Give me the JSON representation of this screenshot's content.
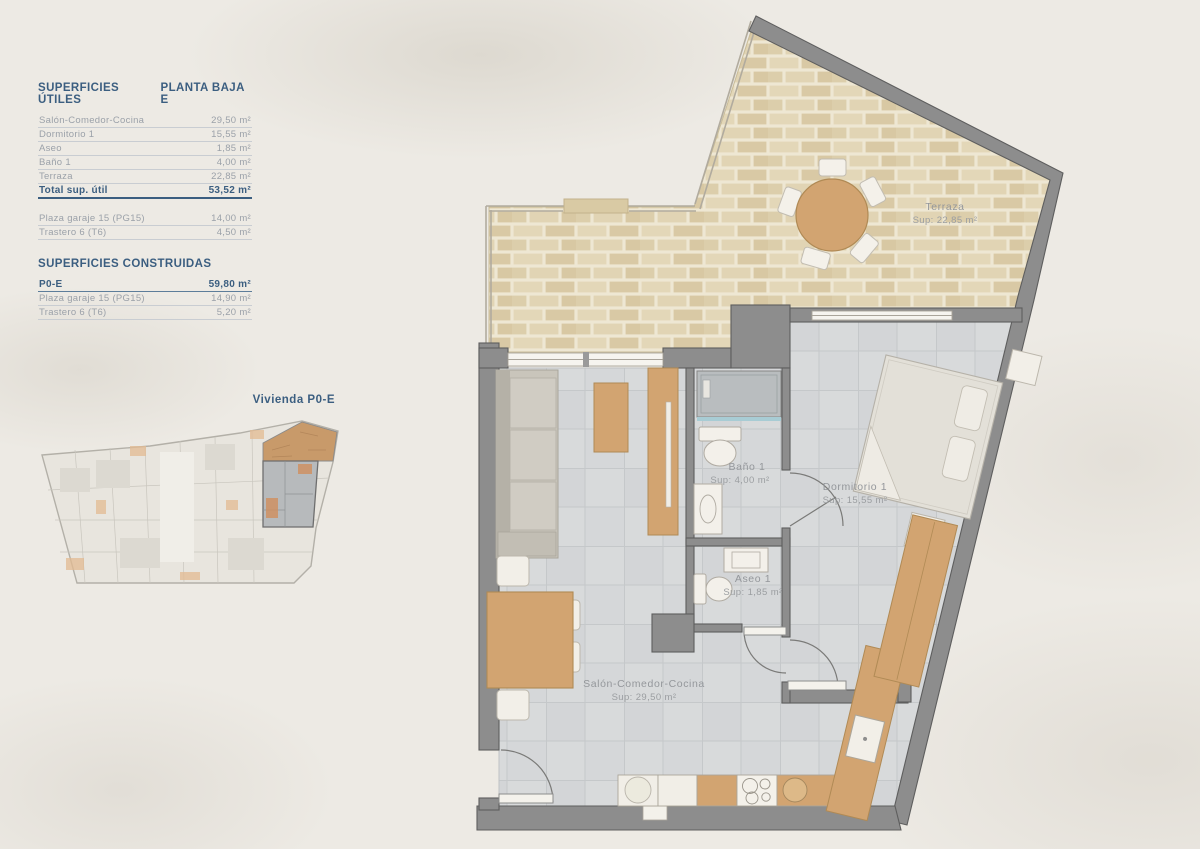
{
  "panel": {
    "title": "SUPERFICIES ÚTILES",
    "plan_name": "PLANTA BAJA E",
    "rows": [
      {
        "label": "Salón-Comedor-Cocina",
        "value": "29,50 m²"
      },
      {
        "label": "Dormitorio 1",
        "value": "15,55 m²"
      },
      {
        "label": "Aseo",
        "value": "1,85 m²"
      },
      {
        "label": "Baño 1",
        "value": "4,00 m²"
      },
      {
        "label": "Terraza",
        "value": "22,85 m²"
      }
    ],
    "total": {
      "label": "Total sup. útil",
      "value": "53,52 m²"
    },
    "annex_rows": [
      {
        "label": "Plaza garaje 15 (PG15)",
        "value": "14,00 m²"
      },
      {
        "label": "Trastero 6 (T6)",
        "value": "4,50 m²"
      }
    ],
    "built_title": "SUPERFICIES CONSTRUIDAS",
    "built_total": {
      "label": "P0-E",
      "value": "59,80 m²"
    },
    "built_rows": [
      {
        "label": "Plaza garaje 15 (PG15)",
        "value": "14,90 m²"
      },
      {
        "label": "Trastero 6 (T6)",
        "value": "5,20 m²"
      }
    ]
  },
  "overview": {
    "label": "Vivienda P0-E"
  },
  "plan": {
    "rooms": {
      "terraza": {
        "name": "Terraza",
        "sup": "Sup: 22,85 m²"
      },
      "dormitorio": {
        "name": "Dormitorio 1",
        "sup": "Sup: 15,55 m²"
      },
      "bano": {
        "name": "Baño 1",
        "sup": "Sup: 4,00 m²"
      },
      "aseo": {
        "name": "Aseo 1",
        "sup": "Sup: 1,85 m²"
      },
      "salon": {
        "name": "Salón-Comedor-Cocina",
        "sup": "Sup: 29,50 m²"
      }
    }
  },
  "colors": {
    "accent_blue": "#3b5e80",
    "wall": "#8d8d8d",
    "wood": "#d2a471",
    "terrace": "#decfae",
    "tile": "#d8dadb",
    "label": "#94979b"
  }
}
